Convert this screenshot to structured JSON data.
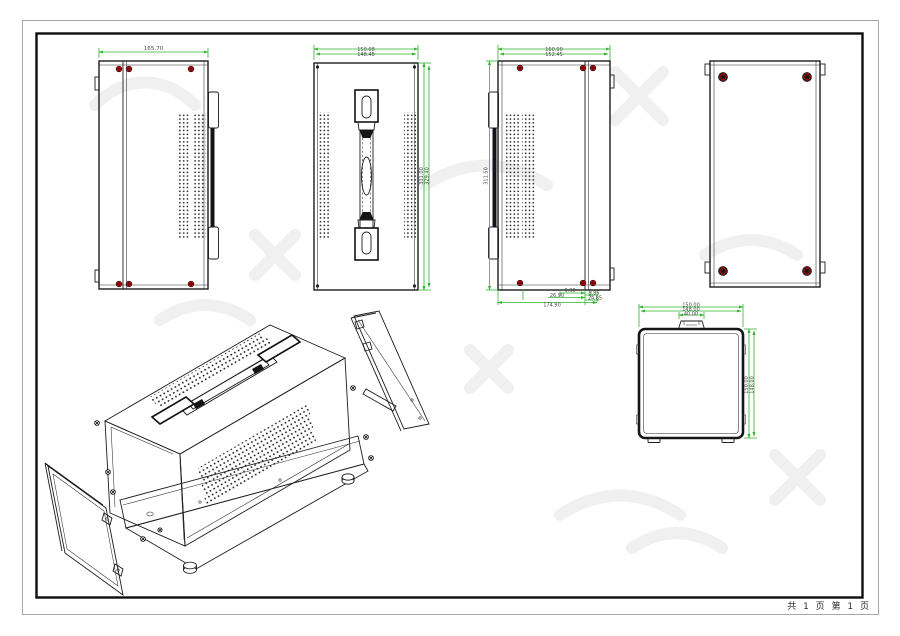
{
  "page": {
    "footer": "共 1 页  第 1 页"
  },
  "dimensions": {
    "side_panel_left": {
      "width": "165.70"
    },
    "top_cover": {
      "width_outer": "150.08",
      "width_inner": "148.48",
      "length_outer": "331.00",
      "length_inner": "329.40"
    },
    "side_panel_right": {
      "width_outer": "160.00",
      "width_inner": "152.45",
      "height": "311.50",
      "bottom_total": "174.90",
      "bottom_mid": "26.90",
      "bottom_small": "6.90",
      "bottom_right_a": "8.85",
      "bottom_right_b": "24.85"
    },
    "end_view": {
      "width_outer": "150.00",
      "width_inner": "148.00",
      "handle_width": "40.00",
      "height_outer": "150.00",
      "height_inner": "148.00"
    }
  },
  "colors": {
    "dimension_line": "#2fb52f",
    "screw_marker": "#c41414",
    "drawing_line": "#1c1c1c"
  }
}
